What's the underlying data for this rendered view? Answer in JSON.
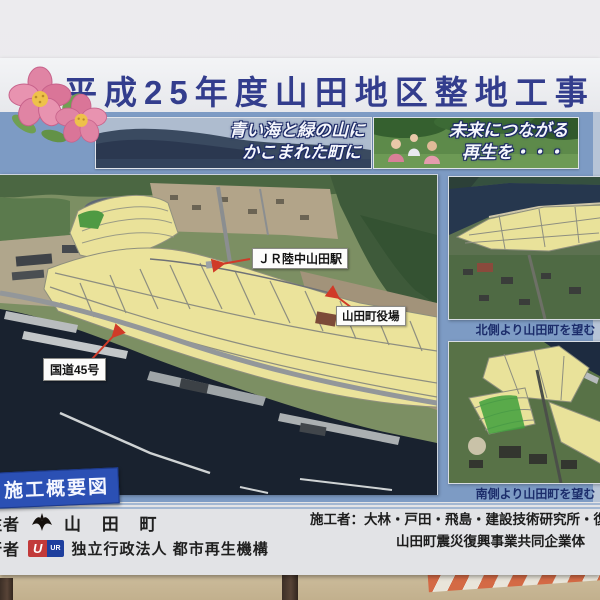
{
  "board": {
    "title": "平成25年度山田地区整地工事",
    "banners": {
      "left": {
        "line1": "青い海と緑の山に",
        "line2": "かこまれた町に"
      },
      "right": {
        "line1": "未来につながる",
        "line2": "再生を・・・"
      }
    },
    "map": {
      "tag": "施工概要図",
      "labels": {
        "station": "ＪＲ陸中山田駅",
        "townhall": "山田町役場",
        "route": "国道45号"
      }
    },
    "photos": {
      "north_caption": "北側より山田町を望む",
      "south_caption": "南側より山田町を望む"
    },
    "footer": {
      "orderer_label_partial": "注者",
      "orderer_value": "山 田 町",
      "operator_label_partial": "行者",
      "operator_value": "独立行政法人 都市再生機構",
      "ur_logo_u": "U",
      "ur_logo_ur": "UR",
      "contractor_line1": "施工者：大林・戸田・飛島・建設技術研究所・復建技術",
      "contractor_line2": "山田町震災復興事業共同企業体"
    },
    "colors": {
      "panel_blue": "#7d9bc4",
      "title_navy": "#333d8d",
      "tag_blue": "#2b50b4",
      "arrow_red": "#d03a28",
      "map_yellow": "#ebe39b",
      "sea_navy": "#19222f",
      "caption_navy": "#1c2d6b"
    }
  }
}
